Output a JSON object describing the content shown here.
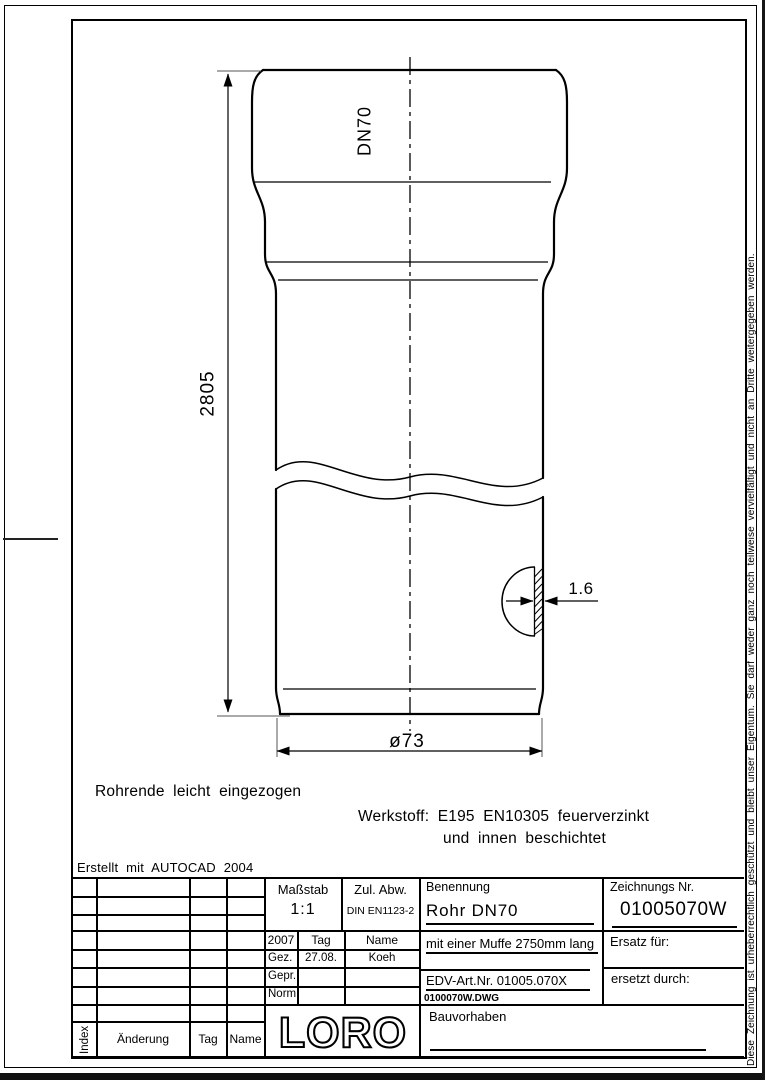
{
  "drawing": {
    "labels": {
      "dn": "DN70",
      "length": "2805",
      "wall": "1.6",
      "diameter": "ø73"
    },
    "notes": {
      "pipe_end": "Rohrende leicht eingezogen",
      "material_line1": "Werkstoff: E195 EN10305 feuerverzinkt",
      "material_line2": "und innen beschichtet",
      "created_with": "Erstellt mit AUTOCAD 2004"
    }
  },
  "title_block": {
    "revision_table": {
      "index_label": "Index",
      "change_label": "Änderung",
      "date_label": "Tag",
      "name_label": "Name"
    },
    "scale": {
      "label": "Maßstab",
      "value": "1:1"
    },
    "tolerance": {
      "label": "Zul. Abw.",
      "value": "DIN EN1123-2"
    },
    "signatures": {
      "year": "2007",
      "date_label": "Tag",
      "name_label": "Name",
      "rows": [
        {
          "label": "Gez.",
          "date": "27.08.",
          "name": "Koeh"
        },
        {
          "label": "Gepr.",
          "date": "",
          "name": ""
        },
        {
          "label": "Norm.",
          "date": "",
          "name": ""
        }
      ]
    },
    "logo_text": "LORO",
    "designation": {
      "label": "Benennung",
      "title": "Rohr DN70",
      "subtitle": "mit einer Muffe 2750mm lang",
      "edv_art_nr": "EDV-Art.Nr. 01005.070X",
      "file_name": "0100070W.DWG",
      "project_label": "Bauvorhaben"
    },
    "drawing_number": {
      "label": "Zeichnungs Nr.",
      "value": "01005070W",
      "replacement_for_label": "Ersatz für:",
      "replaced_by_label": "ersetzt durch:"
    }
  },
  "copyright_notice": "Diese Zeichnung ist urheberrechtlich geschützt und bleibt unser Eigentum. Sie darf weder ganz noch teilweise vervielfältigt und nicht an Dritte weitergegeben werden."
}
